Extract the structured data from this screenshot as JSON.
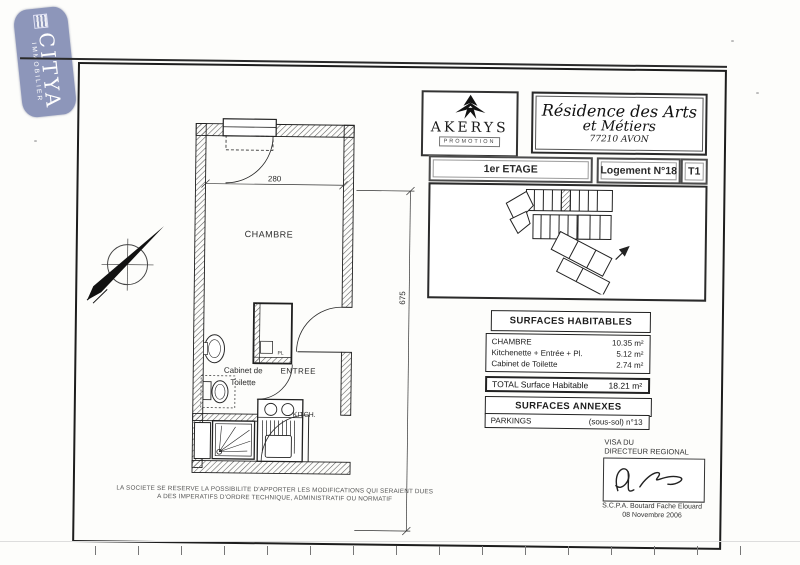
{
  "citya": {
    "name": "CITYA",
    "subtitle": "IMMOBILIER",
    "bg_color": "#8d96ba"
  },
  "akerys": {
    "name": "AKERYS",
    "tagline": "PROMOTION"
  },
  "residence": {
    "line1": "Résidence des Arts",
    "line2": "et Métiers",
    "city": "77210 AVON"
  },
  "location_bar": {
    "etage": "1er ETAGE",
    "logement": "Logement N°18",
    "type": "T1"
  },
  "plan": {
    "labels": {
      "chambre": "CHAMBRE",
      "cabinet_line1": "Cabinet de",
      "cabinet_line2": "Toilette",
      "entree": "ENTREE",
      "kitch": "KITCH.",
      "placard": "PL"
    },
    "dimensions": {
      "width": "280",
      "length": "675"
    }
  },
  "surfaces": {
    "habitables_title": "SURFACES HABITABLES",
    "rows": [
      {
        "label": "CHAMBRE",
        "value": "10.35 m²"
      },
      {
        "label": "Kitchenette + Entrée + Pl.",
        "value": "5.12 m²"
      },
      {
        "label": "Cabinet de Toilette",
        "value": "2.74 m²"
      }
    ],
    "total_label": "TOTAL Surface Habitable",
    "total_value": "18.21 m²",
    "annexes_title": "SURFACES ANNEXES",
    "annexes_rows": [
      {
        "label": "PARKINGS",
        "value": "(sous-sol) n°13"
      }
    ]
  },
  "visa": {
    "line1": "VISA DU",
    "line2": "DIRECTEUR REGIONAL",
    "signatory": "S.C.P.A. Boutard Fache Elouard",
    "date": "08 Novembre 2006"
  },
  "disclaimer": {
    "line1": "LA SOCIETE SE RESERVE LA POSSIBILITE D'APPORTER LES MODIFICATIONS QUI SERAIENT DUES",
    "line2": "A DES IMPERATIFS D'ORDRE TECHNIQUE, ADMINISTRATIF OU NORMATIF"
  }
}
